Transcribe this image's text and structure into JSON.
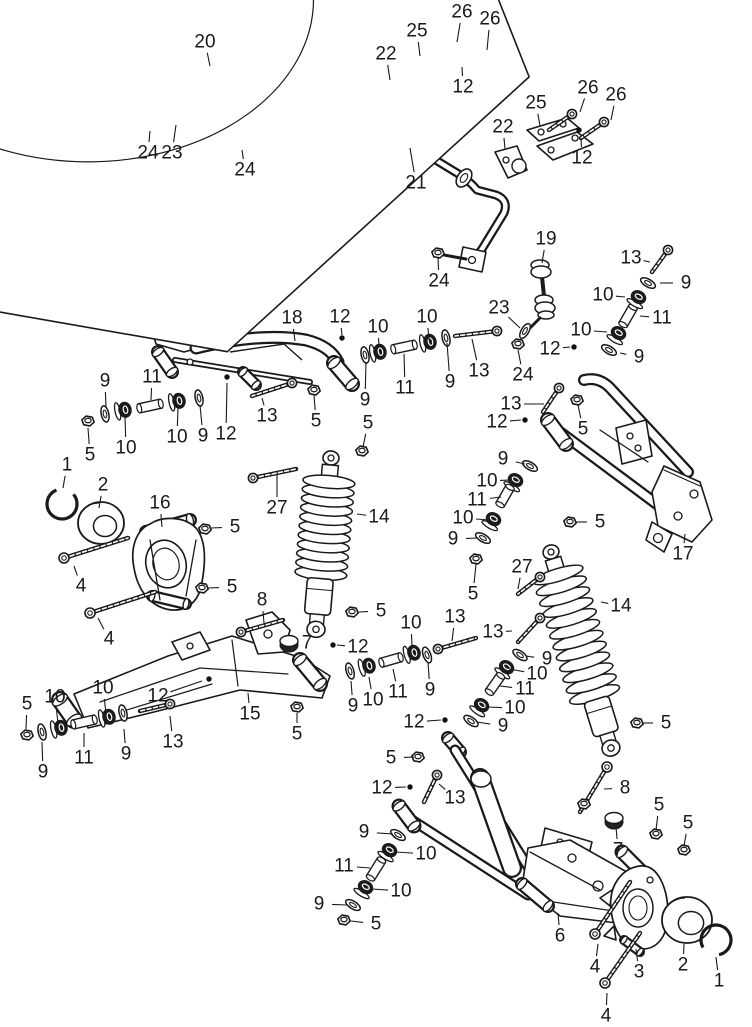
{
  "diagram": {
    "title": "Rear suspension exploded parts diagram",
    "background": "#ffffff",
    "line_color": "#1a1a1a",
    "label_font_size": 19,
    "part_numbers": [
      "1",
      "2",
      "3",
      "4",
      "5",
      "6",
      "7",
      "8",
      "9",
      "10",
      "11",
      "12",
      "13",
      "14",
      "15",
      "16",
      "17",
      "18",
      "19",
      "20",
      "21",
      "22",
      "23",
      "24",
      "25",
      "26",
      "27"
    ],
    "callouts": [
      {
        "n": "20",
        "x": 205,
        "y": 42,
        "tx": 210,
        "ty": 66
      },
      {
        "n": "24",
        "x": 148,
        "y": 153,
        "tx": 150,
        "ty": 131
      },
      {
        "n": "23",
        "x": 172,
        "y": 153,
        "tx": 176,
        "ty": 125
      },
      {
        "n": "24",
        "x": 245,
        "y": 170,
        "tx": 242,
        "ty": 150
      },
      {
        "n": "25",
        "x": 417,
        "y": 31,
        "tx": 420,
        "ty": 56
      },
      {
        "n": "26",
        "x": 462,
        "y": 12,
        "tx": 457,
        "ty": 42
      },
      {
        "n": "26",
        "x": 490,
        "y": 19,
        "tx": 487,
        "ty": 50
      },
      {
        "n": "22",
        "x": 386,
        "y": 54,
        "tx": 390,
        "ty": 80
      },
      {
        "n": "12",
        "x": 463,
        "y": 87,
        "tx": 462,
        "ty": 67
      },
      {
        "n": "25",
        "x": 536,
        "y": 103,
        "tx": 540,
        "ty": 126
      },
      {
        "n": "26",
        "x": 588,
        "y": 88,
        "tx": 580,
        "ty": 112
      },
      {
        "n": "26",
        "x": 616,
        "y": 95,
        "tx": 611,
        "ty": 120
      },
      {
        "n": "22",
        "x": 503,
        "y": 127,
        "tx": 505,
        "ty": 149
      },
      {
        "n": "12",
        "x": 582,
        "y": 158,
        "tx": 581,
        "ty": 138
      },
      {
        "n": "21",
        "x": 416,
        "y": 183,
        "tx": 410,
        "ty": 148
      },
      {
        "n": "24",
        "x": 439,
        "y": 281,
        "tx": 438,
        "ty": 258
      },
      {
        "n": "19",
        "x": 546,
        "y": 239,
        "tx": 542,
        "ty": 263
      },
      {
        "n": "23",
        "x": 499,
        "y": 308,
        "tx": 520,
        "ty": 328
      },
      {
        "n": "24",
        "x": 523,
        "y": 375,
        "tx": 518,
        "ty": 350
      },
      {
        "n": "13",
        "x": 631,
        "y": 258,
        "tx": 650,
        "ty": 262
      },
      {
        "n": "9",
        "x": 686,
        "y": 283,
        "tx": 660,
        "ty": 283
      },
      {
        "n": "10",
        "x": 603,
        "y": 295,
        "tx": 625,
        "ty": 297
      },
      {
        "n": "11",
        "x": 662,
        "y": 318,
        "tx": 640,
        "ty": 316
      },
      {
        "n": "10",
        "x": 581,
        "y": 330,
        "tx": 607,
        "ty": 332
      },
      {
        "n": "12",
        "x": 550,
        "y": 349,
        "tx": 570,
        "ty": 347
      },
      {
        "n": "9",
        "x": 639,
        "y": 357,
        "tx": 620,
        "ty": 353
      },
      {
        "n": "18",
        "x": 292,
        "y": 318,
        "tx": 295,
        "ty": 341
      },
      {
        "n": "12",
        "x": 340,
        "y": 317,
        "tx": 342,
        "ty": 335
      },
      {
        "n": "10",
        "x": 378,
        "y": 327,
        "tx": 379,
        "ty": 347
      },
      {
        "n": "9",
        "x": 105,
        "y": 381,
        "tx": 106,
        "ty": 407
      },
      {
        "n": "11",
        "x": 152,
        "y": 377,
        "tx": 151,
        "ty": 400
      },
      {
        "n": "5",
        "x": 90,
        "y": 455,
        "tx": 88,
        "ty": 428
      },
      {
        "n": "10",
        "x": 126,
        "y": 448,
        "tx": 125,
        "ty": 417
      },
      {
        "n": "10",
        "x": 177,
        "y": 437,
        "tx": 178,
        "ty": 408
      },
      {
        "n": "9",
        "x": 203,
        "y": 436,
        "tx": 200,
        "ty": 405
      },
      {
        "n": "12",
        "x": 226,
        "y": 434,
        "tx": 227,
        "ty": 383
      },
      {
        "n": "13",
        "x": 267,
        "y": 416,
        "tx": 262,
        "ty": 398
      },
      {
        "n": "5",
        "x": 316,
        "y": 421,
        "tx": 314,
        "ty": 395
      },
      {
        "n": "9",
        "x": 365,
        "y": 400,
        "tx": 366,
        "ty": 362
      },
      {
        "n": "10",
        "x": 427,
        "y": 317,
        "tx": 429,
        "ty": 340
      },
      {
        "n": "11",
        "x": 405,
        "y": 388,
        "tx": 404,
        "ty": 354
      },
      {
        "n": "9",
        "x": 450,
        "y": 382,
        "tx": 447,
        "ty": 343
      },
      {
        "n": "13",
        "x": 479,
        "y": 371,
        "tx": 472,
        "ty": 339
      },
      {
        "n": "5",
        "x": 368,
        "y": 423,
        "tx": 363,
        "ty": 447
      },
      {
        "n": "13",
        "x": 511,
        "y": 404,
        "tx": 544,
        "ty": 404
      },
      {
        "n": "12",
        "x": 497,
        "y": 422,
        "tx": 521,
        "ty": 420
      },
      {
        "n": "5",
        "x": 583,
        "y": 429,
        "tx": 578,
        "ty": 405
      },
      {
        "n": "5",
        "x": 600,
        "y": 522,
        "tx": 576,
        "ty": 522
      },
      {
        "n": "17",
        "x": 683,
        "y": 554,
        "tx": 685,
        "ty": 534
      },
      {
        "n": "9",
        "x": 503,
        "y": 459,
        "tx": 525,
        "ty": 464
      },
      {
        "n": "10",
        "x": 487,
        "y": 481,
        "tx": 510,
        "ty": 480
      },
      {
        "n": "11",
        "x": 477,
        "y": 500,
        "tx": 501,
        "ty": 497
      },
      {
        "n": "10",
        "x": 463,
        "y": 518,
        "tx": 489,
        "ty": 520
      },
      {
        "n": "9",
        "x": 453,
        "y": 539,
        "tx": 478,
        "ty": 538
      },
      {
        "n": "5",
        "x": 473,
        "y": 594,
        "tx": 476,
        "ty": 564
      },
      {
        "n": "27",
        "x": 522,
        "y": 567,
        "tx": 518,
        "ty": 589
      },
      {
        "n": "14",
        "x": 621,
        "y": 606,
        "tx": 601,
        "ty": 602
      },
      {
        "n": "1",
        "x": 67,
        "y": 465,
        "tx": 63,
        "ty": 488
      },
      {
        "n": "2",
        "x": 103,
        "y": 485,
        "tx": 99,
        "ty": 508
      },
      {
        "n": "16",
        "x": 160,
        "y": 503,
        "tx": 162,
        "ty": 527
      },
      {
        "n": "5",
        "x": 235,
        "y": 527,
        "tx": 211,
        "ty": 528
      },
      {
        "n": "4",
        "x": 81,
        "y": 586,
        "tx": 74,
        "ty": 566
      },
      {
        "n": "5",
        "x": 232,
        "y": 587,
        "tx": 208,
        "ty": 588
      },
      {
        "n": "4",
        "x": 109,
        "y": 639,
        "tx": 98,
        "ty": 618
      },
      {
        "n": "27",
        "x": 277,
        "y": 508,
        "tx": 277,
        "ty": 474
      },
      {
        "n": "14",
        "x": 379,
        "y": 517,
        "tx": 357,
        "ty": 514
      },
      {
        "n": "5",
        "x": 381,
        "y": 611,
        "tx": 358,
        "ty": 612
      },
      {
        "n": "8",
        "x": 262,
        "y": 600,
        "tx": 264,
        "ty": 623
      },
      {
        "n": "7",
        "x": 307,
        "y": 643,
        "tx": 294,
        "ty": 644
      },
      {
        "n": "12",
        "x": 358,
        "y": 647,
        "tx": 337,
        "ty": 645
      },
      {
        "n": "10",
        "x": 411,
        "y": 623,
        "tx": 412,
        "ty": 646
      },
      {
        "n": "15",
        "x": 250,
        "y": 714,
        "tx": 248,
        "ty": 693
      },
      {
        "n": "12",
        "x": 158,
        "y": 696,
        "tx": 202,
        "ty": 681
      },
      {
        "n": "13",
        "x": 173,
        "y": 742,
        "tx": 170,
        "ty": 716
      },
      {
        "n": "5",
        "x": 297,
        "y": 734,
        "tx": 297,
        "ty": 713
      },
      {
        "n": "9",
        "x": 126,
        "y": 754,
        "tx": 124,
        "ty": 729
      },
      {
        "n": "5",
        "x": 27,
        "y": 704,
        "tx": 26,
        "ty": 729
      },
      {
        "n": "10",
        "x": 55,
        "y": 697,
        "tx": 58,
        "ty": 723
      },
      {
        "n": "10",
        "x": 103,
        "y": 688,
        "tx": 106,
        "ty": 713
      },
      {
        "n": "9",
        "x": 43,
        "y": 772,
        "tx": 42,
        "ty": 742
      },
      {
        "n": "11",
        "x": 84,
        "y": 758,
        "tx": 84,
        "ty": 733
      },
      {
        "n": "9",
        "x": 353,
        "y": 706,
        "tx": 351,
        "ty": 681
      },
      {
        "n": "10",
        "x": 373,
        "y": 700,
        "tx": 369,
        "ty": 677
      },
      {
        "n": "11",
        "x": 398,
        "y": 692,
        "tx": 393,
        "ty": 669
      },
      {
        "n": "12",
        "x": 414,
        "y": 722,
        "tx": 441,
        "ty": 720
      },
      {
        "n": "9",
        "x": 430,
        "y": 690,
        "tx": 428,
        "ty": 662
      },
      {
        "n": "13",
        "x": 455,
        "y": 617,
        "tx": 452,
        "ty": 641
      },
      {
        "n": "13",
        "x": 493,
        "y": 632,
        "tx": 512,
        "ty": 631
      },
      {
        "n": "9",
        "x": 547,
        "y": 659,
        "tx": 526,
        "ty": 656
      },
      {
        "n": "10",
        "x": 537,
        "y": 674,
        "tx": 509,
        "ty": 669
      },
      {
        "n": "11",
        "x": 525,
        "y": 689,
        "tx": 500,
        "ty": 686
      },
      {
        "n": "10",
        "x": 515,
        "y": 708,
        "tx": 487,
        "ty": 707
      },
      {
        "n": "9",
        "x": 503,
        "y": 726,
        "tx": 477,
        "ty": 722
      },
      {
        "n": "5",
        "x": 666,
        "y": 723,
        "tx": 643,
        "ty": 723
      },
      {
        "n": "5",
        "x": 391,
        "y": 758,
        "tx": 414,
        "ty": 757
      },
      {
        "n": "12",
        "x": 382,
        "y": 788,
        "tx": 406,
        "ty": 787
      },
      {
        "n": "13",
        "x": 455,
        "y": 798,
        "tx": 439,
        "ty": 784
      },
      {
        "n": "9",
        "x": 364,
        "y": 832,
        "tx": 393,
        "ty": 834
      },
      {
        "n": "10",
        "x": 426,
        "y": 854,
        "tx": 396,
        "ty": 852
      },
      {
        "n": "11",
        "x": 344,
        "y": 866,
        "tx": 370,
        "ty": 868
      },
      {
        "n": "10",
        "x": 401,
        "y": 891,
        "tx": 372,
        "ty": 889
      },
      {
        "n": "9",
        "x": 319,
        "y": 904,
        "tx": 347,
        "ty": 905
      },
      {
        "n": "5",
        "x": 376,
        "y": 924,
        "tx": 351,
        "ty": 921
      },
      {
        "n": "6",
        "x": 560,
        "y": 936,
        "tx": 558,
        "ty": 913
      },
      {
        "n": "8",
        "x": 625,
        "y": 788,
        "tx": 604,
        "ty": 789
      },
      {
        "n": "7",
        "x": 618,
        "y": 850,
        "tx": 616,
        "ty": 827
      },
      {
        "n": "5",
        "x": 659,
        "y": 805,
        "tx": 656,
        "ty": 830
      },
      {
        "n": "5",
        "x": 688,
        "y": 823,
        "tx": 684,
        "ty": 846
      },
      {
        "n": "4",
        "x": 595,
        "y": 967,
        "tx": 598,
        "ty": 944
      },
      {
        "n": "3",
        "x": 639,
        "y": 972,
        "tx": 636,
        "ty": 949
      },
      {
        "n": "2",
        "x": 683,
        "y": 965,
        "tx": 684,
        "ty": 944
      },
      {
        "n": "1",
        "x": 719,
        "y": 981,
        "tx": 716,
        "ty": 957
      },
      {
        "n": "4",
        "x": 606,
        "y": 1016,
        "tx": 607,
        "ty": 993
      }
    ]
  }
}
